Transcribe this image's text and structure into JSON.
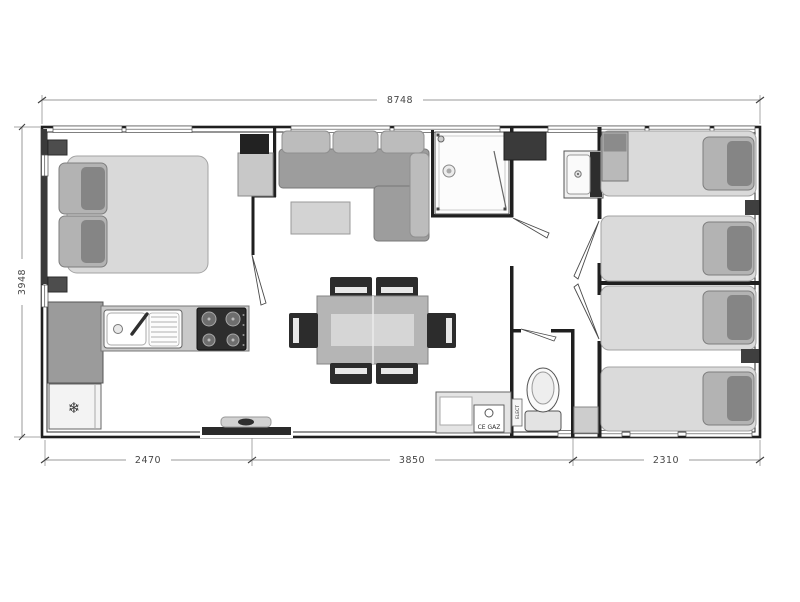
{
  "dimensions": {
    "top_width": "8748",
    "left_height": "3948",
    "bottom": [
      "2470",
      "3850",
      "2310"
    ]
  },
  "labels": {
    "gas_heater": "CE GAZ",
    "electrical_panel": "ELECT"
  },
  "icons": {
    "fridge_snowflake": "❄"
  },
  "colors": {
    "wall": "#1f1f1f",
    "dimension_line": "#8a8a8a",
    "dimension_text": "#474747",
    "furniture_light": "#d9d9d9",
    "furniture_mid": "#9d9d9d",
    "furniture_dark": "#2f2f2f"
  }
}
